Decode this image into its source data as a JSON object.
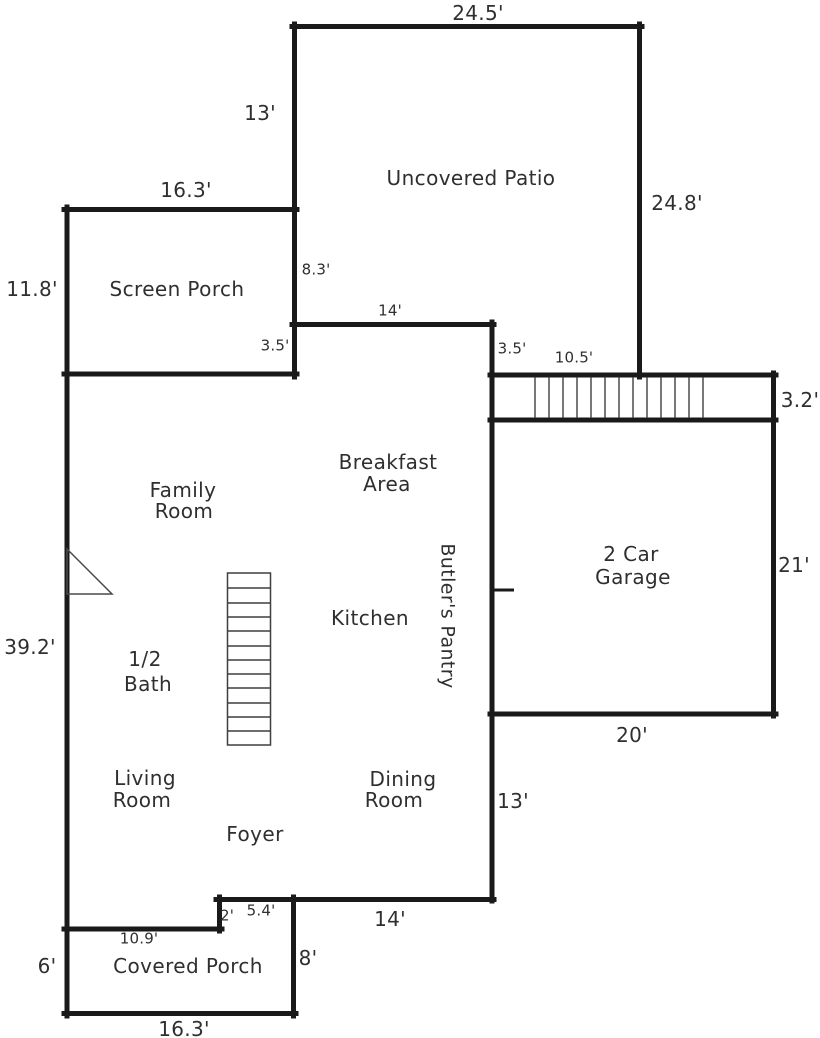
{
  "plan": {
    "background": "#ffffff",
    "wall_color": "#1a1a1a",
    "text_color": "#2f2f2f"
  },
  "rooms": {
    "uncovered_patio": {
      "line1": "Uncovered Patio"
    },
    "screen_porch": {
      "line1": "Screen Porch"
    },
    "breakfast_area": {
      "line1": "Breakfast",
      "line2": "Area"
    },
    "family_room": {
      "line1": "Family",
      "line2": "Room"
    },
    "kitchen": {
      "line1": "Kitchen"
    },
    "butlers_pantry": {
      "line1": "Butler's Pantry"
    },
    "half_bath": {
      "line1": "1/2",
      "line2": "Bath"
    },
    "living_room": {
      "line1": "Living",
      "line2": "Room"
    },
    "dining_room": {
      "line1": "Dining",
      "line2": "Room"
    },
    "foyer": {
      "line1": "Foyer"
    },
    "garage": {
      "line1": "2 Car",
      "line2": "Garage"
    },
    "covered_porch": {
      "line1": "Covered Porch"
    }
  },
  "dimensions": {
    "patio_top": "24.5'",
    "patio_left": "13'",
    "patio_right": "24.8'",
    "screen_porch_top": "16.3'",
    "screen_porch_left": "11.8'",
    "screen_porch_right": "8.3'",
    "breakfast_top": "14'",
    "wall_3_5_left": "3.5'",
    "wall_3_5_right": "3.5'",
    "ext_stairs_top": "10.5'",
    "ext_stairs_right": "3.2'",
    "garage_right": "21'",
    "garage_bottom": "20'",
    "house_left": "39.2'",
    "house_right": "13'",
    "house_bottom": "14'",
    "step_vertical": "2'",
    "step_horizontal": "5.4'",
    "covered_porch_top": "10.9'",
    "covered_porch_left": "6'",
    "covered_porch_right": "8'",
    "covered_porch_bottom": "16.3'"
  }
}
